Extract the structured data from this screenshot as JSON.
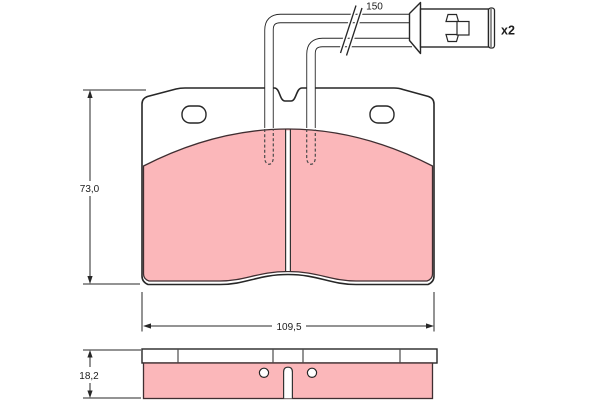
{
  "labels": {
    "wire_length": "150",
    "quantity": "x2",
    "pad_height": "73,0",
    "pad_width": "109,5",
    "pad_thickness": "18,2"
  },
  "colors": {
    "friction_material": "#fbb7ba",
    "outline": "#272727",
    "pad_edge": "#3f2e31"
  }
}
